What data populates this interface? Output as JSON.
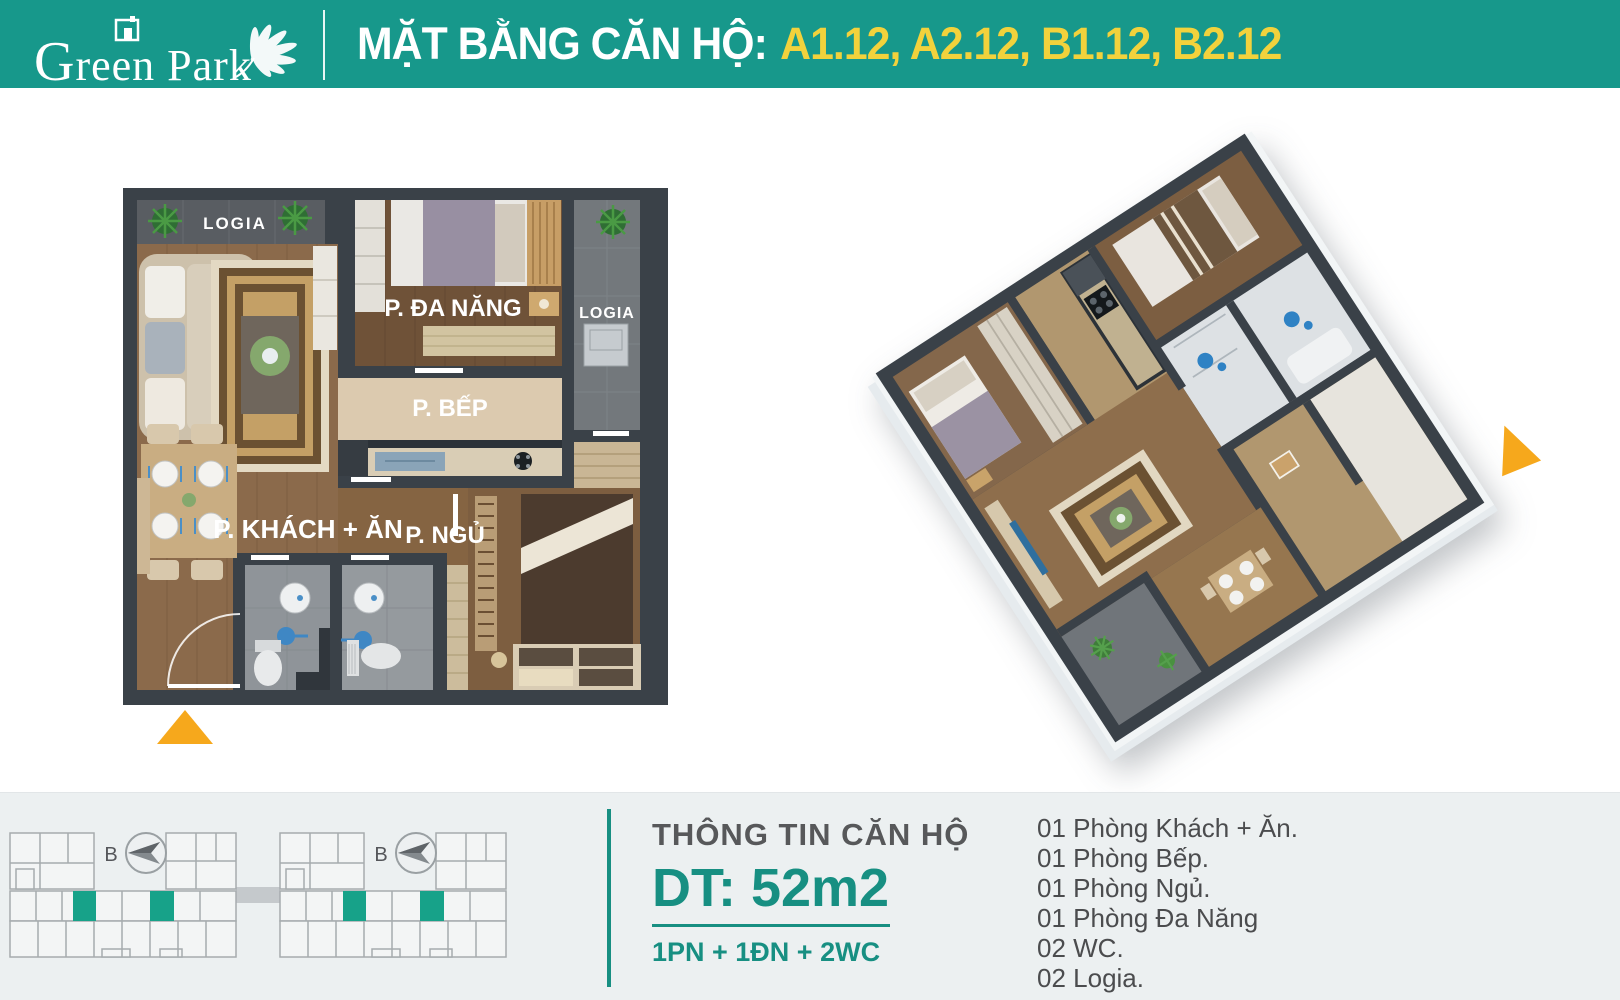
{
  "header": {
    "logo_text_g": "G",
    "logo_text_rest": "reen Park",
    "title_prefix": "MẶT BẰNG CĂN HỘ:",
    "title_units": "A1.12, A2.12, B1.12, B2.12"
  },
  "plan2d": {
    "labels": {
      "logia_top": "LOGIA",
      "multipurpose": "P. ĐA NĂNG",
      "logia_right": "LOGIA",
      "kitchen": "P. BẾP",
      "living": "P. KHÁCH + ĂN",
      "bedroom": "P. NGỦ"
    }
  },
  "keyplan": {
    "compass_label": "B",
    "highlight_color": "#17a289"
  },
  "info": {
    "title": "THÔNG TIN CĂN HỘ",
    "area": "DT: 52m2",
    "config": "1PN + 1ĐN + 2WC",
    "rooms": [
      "01 Phòng Khách + Ăn.",
      "01 Phòng Bếp.",
      "01 Phòng Ngủ.",
      "01 Phòng Đa Năng",
      "02 WC.",
      "02 Logia."
    ]
  },
  "colors": {
    "teal_header": "#17988b",
    "teal_accent": "#178f82",
    "yellow_units": "#f2d23c",
    "orange_arrow": "#f6a81c",
    "wall": "#3a4148",
    "wood_living": "#8b6a4b",
    "wood_dark": "#6f5238",
    "kitchen_floor": "#dccaaf",
    "bath_floor": "#8f9499",
    "logia_floor": "#73787c",
    "footer_bg": "#ecf0f1"
  }
}
